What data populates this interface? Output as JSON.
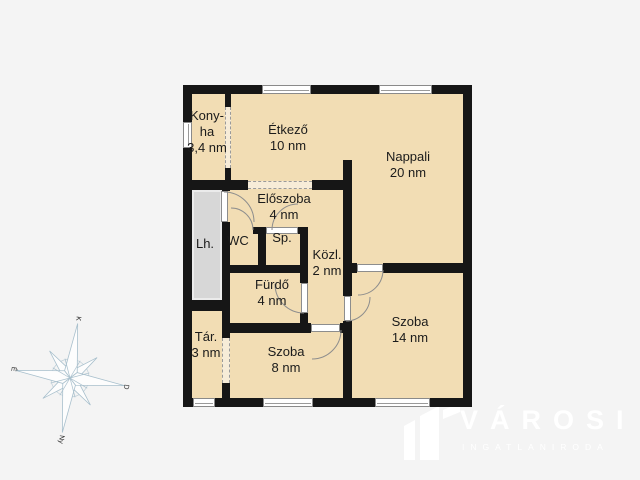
{
  "rooms": {
    "konyha": {
      "line1": "Kony-",
      "line2": "ha",
      "area": "3,4 nm"
    },
    "etkezo": {
      "name": "Étkező",
      "area": "10 nm"
    },
    "nappali": {
      "name": "Nappali",
      "area": "20 nm"
    },
    "eloszoba": {
      "name": "Előszoba",
      "area": "4 nm"
    },
    "wc": {
      "name": "WC"
    },
    "sp": {
      "name": "Sp."
    },
    "kozl": {
      "name": "Közl.",
      "area": "2 nm"
    },
    "lh": {
      "name": "Lh."
    },
    "furdo": {
      "name": "Fürdő",
      "area": "4 nm"
    },
    "tar": {
      "name": "Tár.",
      "area": "3 nm"
    },
    "szoba8": {
      "name": "Szoba",
      "area": "8 nm"
    },
    "szoba14": {
      "name": "Szoba",
      "area": "14 nm"
    }
  },
  "compass": {
    "top": "K",
    "right": "D",
    "bottom": "Ny",
    "left": "É"
  },
  "logo": {
    "brand": "VÁROSI",
    "subtitle": "INGATLANIRODA"
  },
  "colors": {
    "background": "#f4f4f4",
    "room_fill": "#f2ddb4",
    "wall": "#161616",
    "stair_fill": "#d7d7d7",
    "opening_dash": "#9a9a9a",
    "door_line": "#8d8d8d",
    "compass_stroke": "#a9c0cd",
    "logo_color": "#ffffff",
    "label_color": "#1b1b1b"
  }
}
